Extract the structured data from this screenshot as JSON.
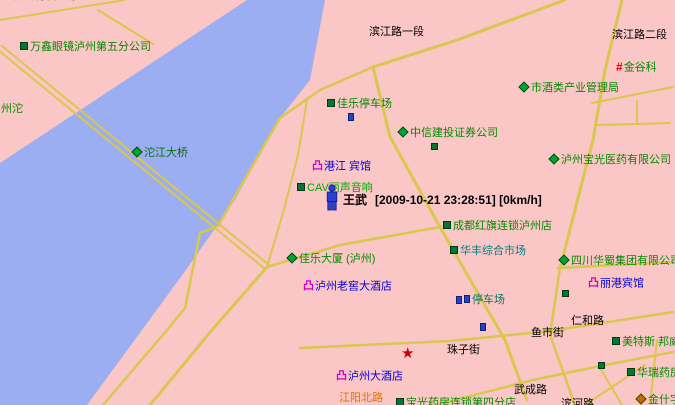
{
  "app": {
    "view": "gps-tracking-map",
    "colors": {
      "land": "#FBC6C6",
      "river": "#9BAEF1",
      "road": "#D9C74E",
      "poi_green": "#008A00",
      "hotel_blue": "#0000D8",
      "hotel_icon_magenta": "#C800C8",
      "road_label_black": "#000000",
      "street_orange": "#E87000",
      "marker_blue": "#2B3FD6",
      "star_red": "#CC0000"
    }
  },
  "tracker": {
    "name": "王武",
    "date": "2009-10-21",
    "time": "23:28:51",
    "speed": "0km/h",
    "info": "[2009-10-21 23:28:51] [0km/h]",
    "x": 343,
    "y": 191,
    "person_icon": {
      "x": 325,
      "y": 184
    }
  },
  "icon_glyphs": {
    "hotel": "凸",
    "hash": "#",
    "star": "★"
  },
  "road_labels": [
    {
      "text": "滨江路一段",
      "x": 369,
      "y": 26
    },
    {
      "text": "滨江路二段",
      "x": 612,
      "y": 29
    },
    {
      "text": "仁和路",
      "x": 571,
      "y": 315
    },
    {
      "text": "鱼市街",
      "x": 531,
      "y": 327
    },
    {
      "text": "珠子街",
      "x": 447,
      "y": 344
    },
    {
      "text": "武成路",
      "x": 514,
      "y": 384
    },
    {
      "text": "滨河路",
      "x": 561,
      "y": 398
    },
    {
      "text": "江阳北路",
      "x": 339,
      "y": 392,
      "color": "#E87000"
    },
    {
      "text": "州沱",
      "x": 1,
      "y": 103,
      "color": "#008A00"
    }
  ],
  "poi_labels": [
    {
      "icon": "none",
      "text": "工商银行营业厅",
      "x": 2,
      "y": -10
    },
    {
      "icon": "square",
      "text": "万鑫眼镜泸州第五分公司",
      "x": 20,
      "y": 41
    },
    {
      "icon": "diamond",
      "text": "沱江大桥",
      "x": 133,
      "y": 147,
      "color": "#007500"
    },
    {
      "icon": "square",
      "text": "佳乐停车场",
      "x": 327,
      "y": 98
    },
    {
      "icon": "diamond",
      "text": "中信建投证券公司",
      "x": 399,
      "y": 127
    },
    {
      "icon": "hotel",
      "text": "港江 宾馆",
      "x": 312,
      "y": 160,
      "color": "#0000D8"
    },
    {
      "icon": "square",
      "text": "CAV丽声音响",
      "x": 297,
      "y": 182,
      "color": "#00A800"
    },
    {
      "icon": "diamond",
      "text": "市酒类产业管理局",
      "x": 520,
      "y": 82
    },
    {
      "icon": "hash",
      "text": "金谷科",
      "x": 616,
      "y": 61
    },
    {
      "icon": "diamond",
      "text": "泸州宝光医药有限公司",
      "x": 550,
      "y": 154
    },
    {
      "icon": "square",
      "text": "成都红旗连锁泸州店",
      "x": 443,
      "y": 220
    },
    {
      "icon": "square",
      "text": "华丰综合市场",
      "x": 450,
      "y": 245,
      "color": "#008080"
    },
    {
      "icon": "diamond",
      "text": "佳乐大厦 (泸州)",
      "x": 288,
      "y": 253
    },
    {
      "icon": "hotel",
      "text": "泸州老窖大酒店",
      "x": 303,
      "y": 280,
      "color": "#0000D8"
    },
    {
      "icon": "mini",
      "text": "停车场",
      "x": 464,
      "y": 294,
      "color": "#007860"
    },
    {
      "icon": "diamond",
      "text": "四川华蜀集团有限公司",
      "x": 560,
      "y": 255
    },
    {
      "icon": "hotel",
      "text": "丽港宾馆",
      "x": 588,
      "y": 277,
      "color": "#0000D8"
    },
    {
      "icon": "square",
      "text": "美特斯 邦威",
      "x": 612,
      "y": 336
    },
    {
      "icon": "square",
      "text": "华瑞药房",
      "x": 627,
      "y": 367
    },
    {
      "icon": "hotel",
      "text": "泸州大酒店",
      "x": 336,
      "y": 370,
      "color": "#0000D8"
    },
    {
      "icon": "square",
      "text": "宝光药房连锁第四分店",
      "x": 396,
      "y": 397
    },
    {
      "icon": "orange-diamond",
      "text": "金什字",
      "x": 637,
      "y": 394
    }
  ],
  "marks": [
    {
      "type": "mini",
      "x": 348,
      "y": 113
    },
    {
      "type": "mini",
      "x": 456,
      "y": 296
    },
    {
      "type": "mini",
      "x": 480,
      "y": 323
    },
    {
      "type": "square",
      "x": 431,
      "y": 143
    },
    {
      "type": "square",
      "x": 562,
      "y": 290
    },
    {
      "type": "square",
      "x": 598,
      "y": 362
    },
    {
      "type": "star",
      "x": 401,
      "y": 346
    }
  ]
}
